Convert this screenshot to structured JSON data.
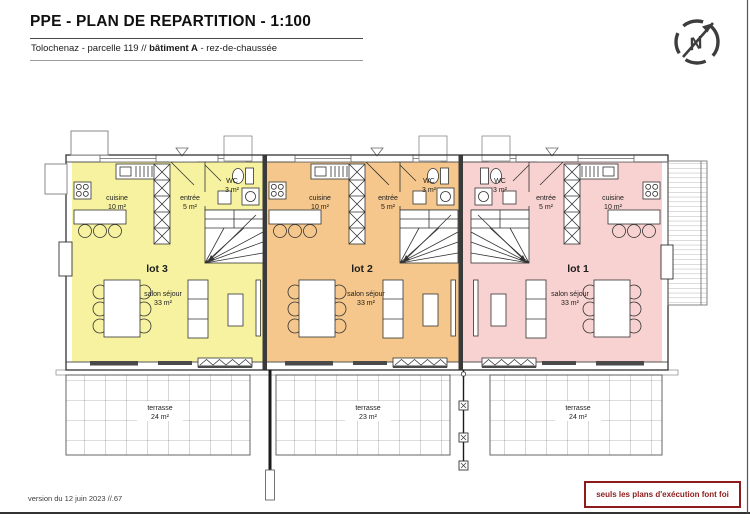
{
  "header": {
    "title": "PPE - PLAN DE REPARTITION - 1:100",
    "subtitle_prefix": "Tolochenaz - parcelle 119 // ",
    "subtitle_bold": "bâtiment A",
    "subtitle_suffix": " - rez-de-chaussée"
  },
  "north": {
    "label": "N"
  },
  "units": [
    {
      "label": "lot 3",
      "color": "#f6f2a0",
      "rooms": {
        "cuisine": {
          "name": "cuisine",
          "area": "10 m²"
        },
        "entree": {
          "name": "entrée",
          "area": "5 m²"
        },
        "wc": {
          "name": "WC",
          "area": "3 m²"
        },
        "salon": {
          "name": "salon séjour",
          "area": "33 m²"
        }
      },
      "terrace": {
        "name": "terrasse",
        "area": "24 m²"
      }
    },
    {
      "label": "lot 2",
      "color": "#f5c78c",
      "rooms": {
        "cuisine": {
          "name": "cuisine",
          "area": "10 m²"
        },
        "entree": {
          "name": "entrée",
          "area": "5 m²"
        },
        "wc": {
          "name": "WC",
          "area": "3 m²"
        },
        "salon": {
          "name": "salon séjour",
          "area": "33 m²"
        }
      },
      "terrace": {
        "name": "terrasse",
        "area": "23 m²"
      }
    },
    {
      "label": "lot 1",
      "color": "#f8d2d0",
      "rooms": {
        "cuisine": {
          "name": "cuisine",
          "area": "10 m²"
        },
        "entree": {
          "name": "entrée",
          "area": "5 m²"
        },
        "wc": {
          "name": "WC",
          "area": "3 m²"
        },
        "salon": {
          "name": "salon séjour",
          "area": "33 m²"
        }
      },
      "terrace": {
        "name": "terrasse",
        "area": "24 m²"
      }
    }
  ],
  "footer": {
    "version": "version du 12 juin 2023 //.67",
    "disclaimer": "seuls les plans d'exécution font foi"
  },
  "colors": {
    "accent_red": "#8e1b1b",
    "wall": "#333333"
  }
}
